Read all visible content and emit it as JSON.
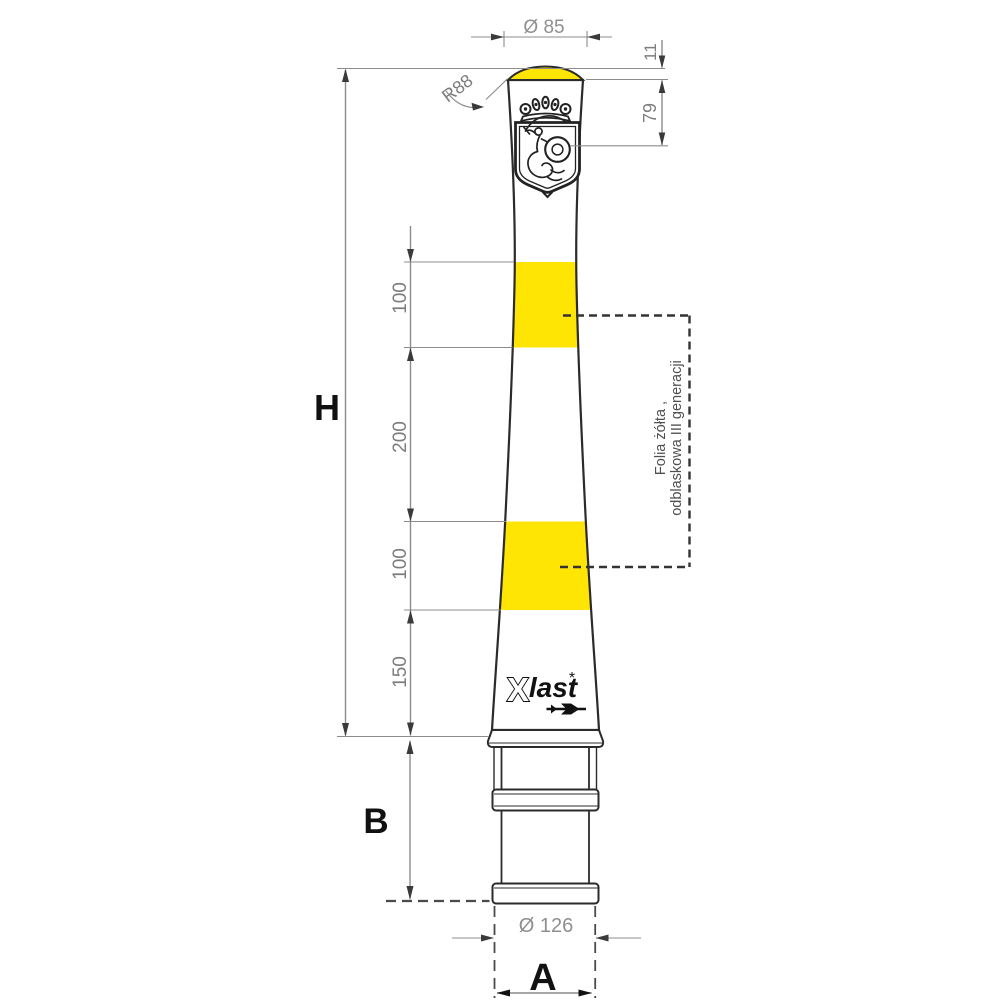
{
  "drawing": {
    "kind": "bollard-technical-drawing",
    "colors": {
      "background": "#ffffff",
      "reflective_band_yellow": "#ffe504",
      "outline": "#2b2b2b",
      "dimension_line": "#8c8c8c",
      "dimension_text": "#7d7d7d"
    }
  },
  "dims": {
    "top_diameter": "Ø 85",
    "cap_height": "11",
    "crest_offset": "79",
    "top_radius": "R88",
    "band_top_height": "100",
    "band_gap": "200",
    "band_bottom_height": "100",
    "below_band": "150",
    "overall_height_label": "H",
    "embed_depth_label": "B",
    "base_diameter": "Ø 126",
    "base_width_label": "A"
  },
  "note": {
    "line1": "Folia żółta ,",
    "line2": "odblaskowa III generacji"
  },
  "logo": {
    "mark": "X",
    "name": "last",
    "reg": "*"
  }
}
